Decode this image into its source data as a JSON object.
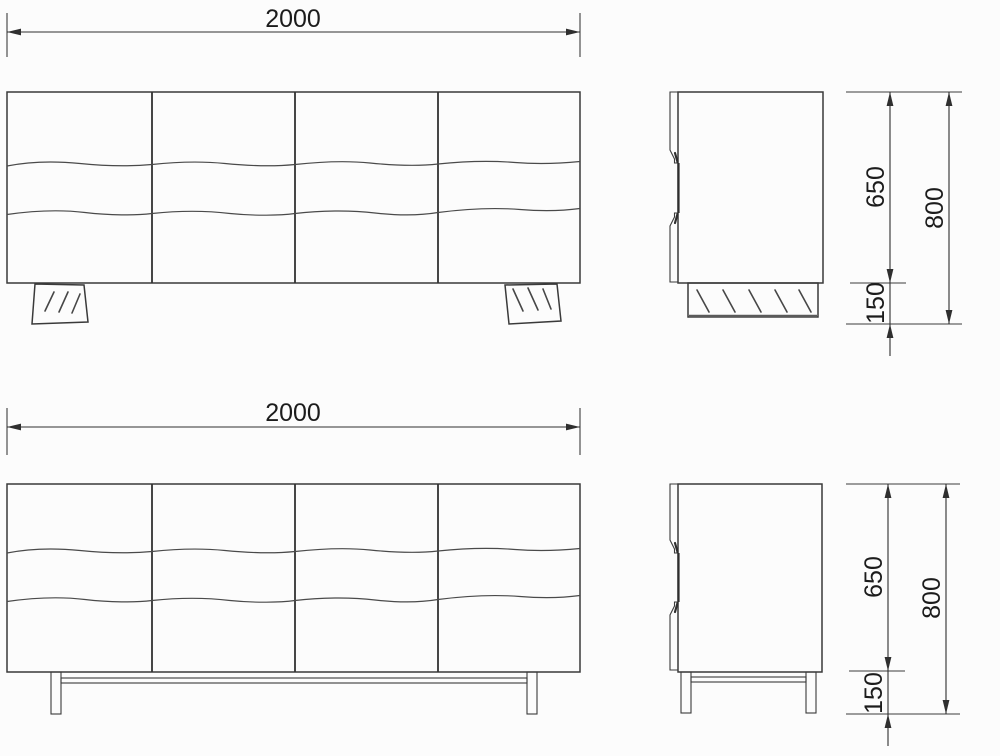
{
  "colors": {
    "background": "#fcfcfc",
    "line": "#3a3a3a",
    "dimension_line": "#2f2f2f",
    "label_text": "#1c1c1c"
  },
  "views": {
    "plinth_variant": {
      "front": {
        "width": "2000"
      },
      "side": {
        "body_height": "650",
        "total_height": "800",
        "base_height": "150"
      }
    },
    "leg_variant": {
      "front": {
        "width": "2000"
      },
      "side": {
        "body_height": "650",
        "total_height": "800",
        "base_height": "150"
      }
    }
  }
}
